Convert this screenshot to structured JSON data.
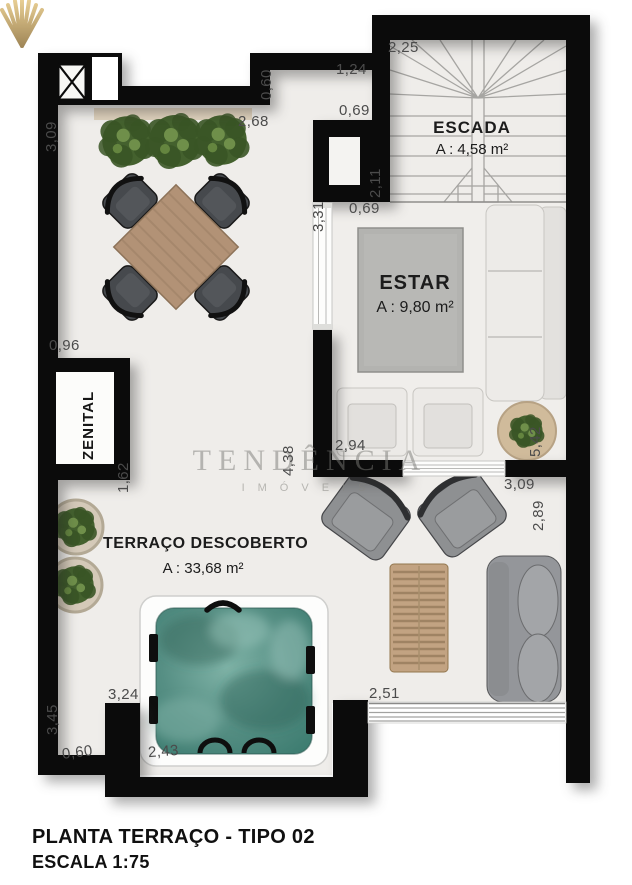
{
  "plan": {
    "footer": {
      "line1": "PLANTA TERRAÇO - TIPO 02",
      "line2": "ESCALA 1:75"
    },
    "watermark": {
      "name": "TENDÊNCIA",
      "subtitle": "IMÓVEIS",
      "logo": "shell-fan-icon",
      "gold": "#c8a14e"
    },
    "rooms": {
      "escada": {
        "name": "ESCADA",
        "area": "A : 4,58 m²"
      },
      "estar": {
        "name": "ESTAR",
        "area": "A : 9,80 m²"
      },
      "terraco": {
        "name": "TERRAÇO DESCOBERTO",
        "area": "A : 33,68 m²"
      },
      "zenital": {
        "name": "ZENITAL"
      }
    },
    "colors": {
      "wall": "#0b0b0b",
      "floor": "#efedea",
      "water": "#568f84",
      "wood": "#b29276",
      "wicker": "#c2a382"
    }
  },
  "dimensions": [
    {
      "id": "d1",
      "label": "3,09",
      "orient": "v"
    },
    {
      "id": "d2",
      "label": "2,68",
      "orient": "h"
    },
    {
      "id": "d3",
      "label": "0,60",
      "orient": "v"
    },
    {
      "id": "d4",
      "label": "1,24",
      "orient": "h"
    },
    {
      "id": "d5",
      "label": "0,69",
      "orient": "h"
    },
    {
      "id": "d6",
      "label": "2,25",
      "orient": "h"
    },
    {
      "id": "d7",
      "label": "2,11",
      "orient": "v"
    },
    {
      "id": "d8",
      "label": "3,31",
      "orient": "v"
    },
    {
      "id": "d9",
      "label": "0,69",
      "orient": "h"
    },
    {
      "id": "d10",
      "label": "0,96",
      "orient": "h"
    },
    {
      "id": "d11",
      "label": "1,62",
      "orient": "v"
    },
    {
      "id": "d12",
      "label": "4,38",
      "orient": "v"
    },
    {
      "id": "d13",
      "label": "2,94",
      "orient": "h"
    },
    {
      "id": "d14",
      "label": "5,42",
      "orient": "v"
    },
    {
      "id": "d15",
      "label": "3,09",
      "orient": "h"
    },
    {
      "id": "d16",
      "label": "2,89",
      "orient": "v"
    },
    {
      "id": "d17",
      "label": "3,24",
      "orient": "h"
    },
    {
      "id": "d18",
      "label": "3,45",
      "orient": "v"
    },
    {
      "id": "d19",
      "label": "0,60",
      "orient": "h"
    },
    {
      "id": "d20",
      "label": "2,43",
      "orient": "h"
    },
    {
      "id": "d21",
      "label": "2,51",
      "orient": "h"
    }
  ]
}
